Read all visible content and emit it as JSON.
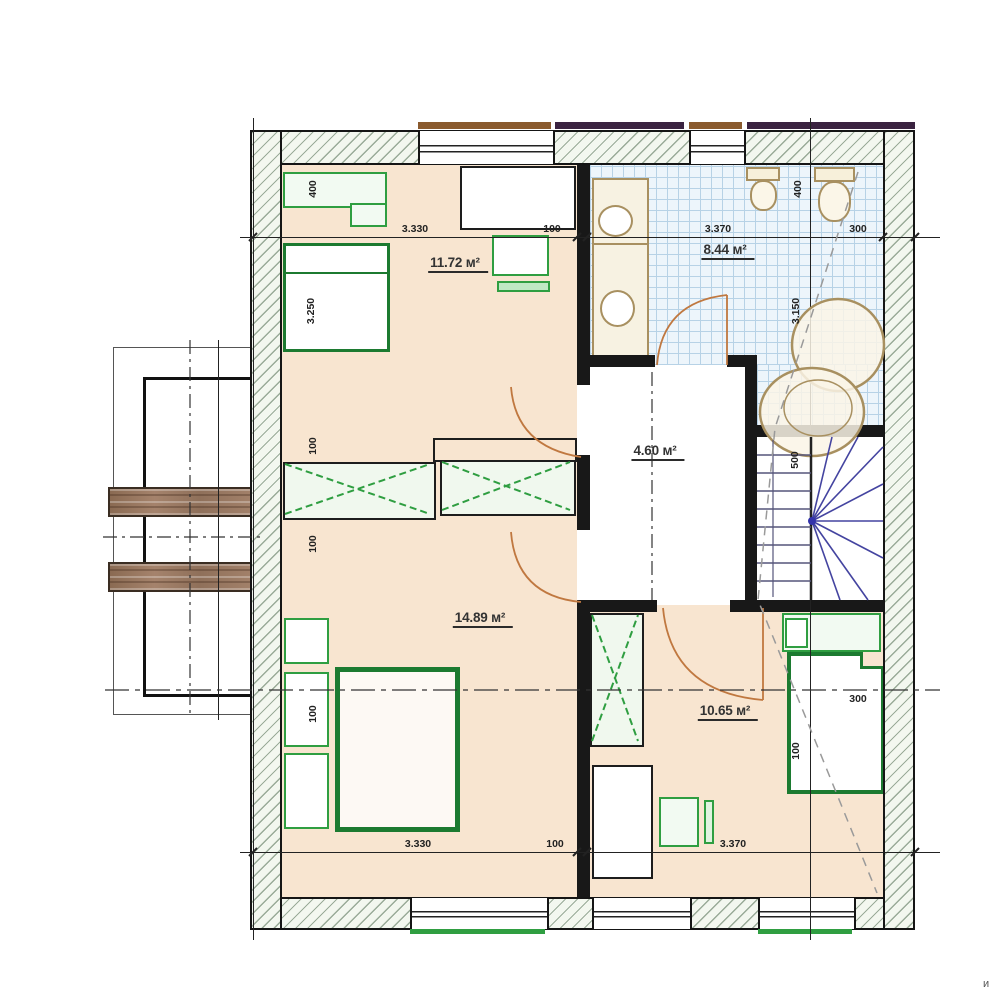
{
  "plan": {
    "area_labels": {
      "bedroom1": "11.72 м²",
      "bathroom": "8.44 м²",
      "hall": "4.60 м²",
      "bedroom2": "14.89 м²",
      "bedroom3": "10.65 м²"
    },
    "dimensions": {
      "top": [
        "3.330",
        "100",
        "3.370",
        "300"
      ],
      "bottom": [
        "3.330",
        "100",
        "3.370"
      ],
      "left": [
        "400",
        "3.250",
        "100",
        "100",
        "100"
      ],
      "right": [
        "400",
        "3.150",
        "500",
        "100",
        "300"
      ]
    },
    "watermark": "и",
    "colors": {
      "floor_beige": "#f8e5d0",
      "tile_blue": "#edf5fb",
      "furniture_green": "#1c7a30",
      "door_tan": "#c07840",
      "stair_blue": "#4444a0",
      "wood_brown": "#9a7a60"
    }
  }
}
